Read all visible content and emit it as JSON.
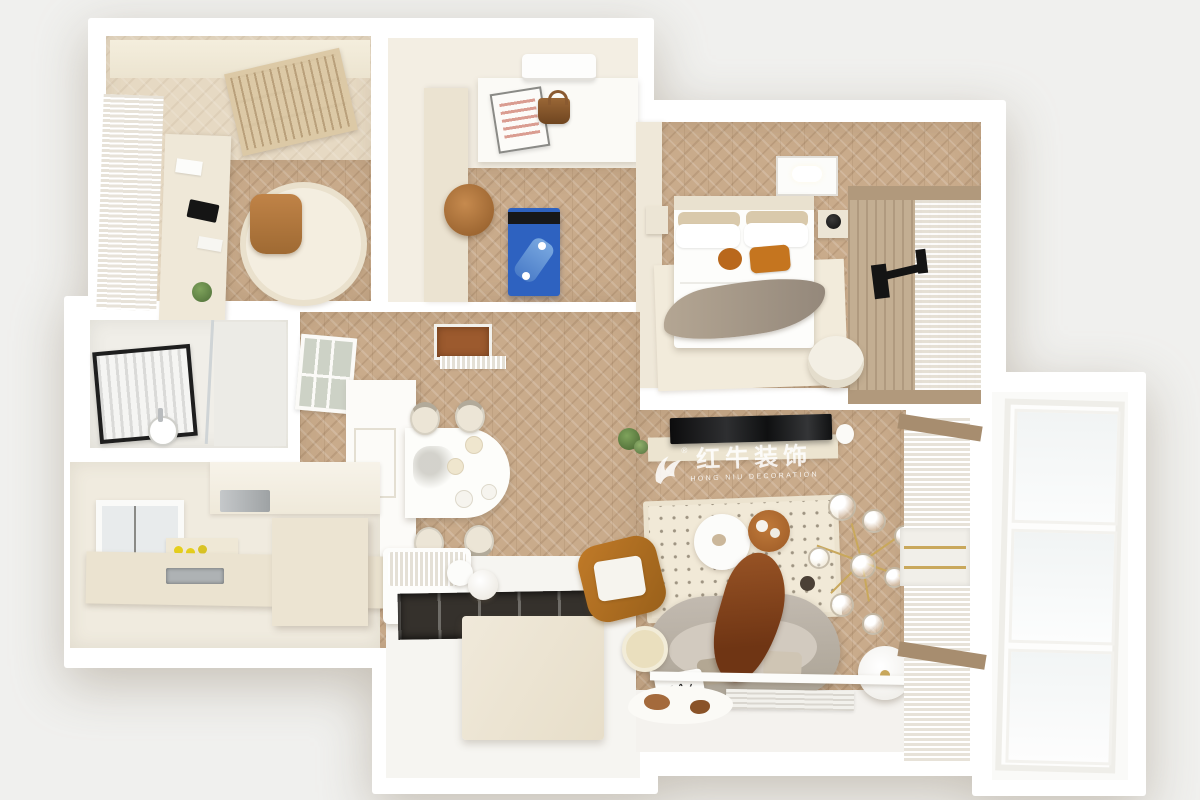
{
  "watermark": {
    "registered": "®",
    "brand_cn": "红牛装饰",
    "brand_en": "HONG NIU DECORATION",
    "logo": "bull-swoosh-logo",
    "color": "#ffffff"
  },
  "scene": {
    "type": "top-down 3D apartment render",
    "background": "#f0f0ee",
    "palette": {
      "walls": "#ffffff",
      "floor_wood_warm": "#c9ab8b",
      "floor_wood_pale": "#e6d9c3",
      "cream_furniture": "#ece4d2",
      "treadmill_blue": "#2e62c0",
      "accent_orange": "#c5751f",
      "sofa_gray": "#b8b0a5",
      "throw_brown": "#84451f",
      "bean_bag_tan": "#b0773f",
      "mirror_frame_black": "#1e1e1e"
    },
    "rooms": [
      {
        "name": "study",
        "objects": [
          "wardrobe",
          "bookshelf",
          "window-curtain",
          "desk",
          "monitor",
          "desk-chair",
          "oval-rug",
          "plant"
        ]
      },
      {
        "name": "fitness-room",
        "objects": [
          "air-conditioner",
          "counter",
          "picture-frame",
          "handbag",
          "bean-bag",
          "treadmill"
        ]
      },
      {
        "name": "master-bedroom",
        "objects": [
          "wardrobe",
          "double-bed",
          "pillows",
          "orange-cushions",
          "throw-blanket",
          "nightstands",
          "ceiling-light",
          "wood-slat-tv-wall",
          "tv-bracket",
          "curtains",
          "armchair",
          "area-rug"
        ]
      },
      {
        "name": "bathroom",
        "objects": [
          "framed-mirror",
          "sink",
          "glass-partition"
        ]
      },
      {
        "name": "kitchen",
        "objects": [
          "window",
          "upper-cabinets",
          "range-hood",
          "fruit-shelf",
          "counter",
          "sink",
          "island"
        ]
      },
      {
        "name": "dining-hall",
        "objects": [
          "glass-grid-partition",
          "skylight",
          "doormat",
          "island-counter",
          "oval-dining-table",
          "dining-chairs",
          "tableware"
        ]
      },
      {
        "name": "entry",
        "objects": [
          "bench",
          "bolster-cushion",
          "floor-recess",
          "cabinet-block",
          "pouf"
        ]
      },
      {
        "name": "living-room",
        "objects": [
          "tv",
          "tv-console",
          "plant",
          "polka-dot-rug",
          "round-coffee-table",
          "wood-tray-table",
          "curved-sofa",
          "throw-blanket",
          "script-pillow",
          "side-table",
          "chandelier",
          "floor-lamp",
          "shelf-strip",
          "doormat",
          "cowhide-rug",
          "curtains",
          "lounge-chair"
        ]
      },
      {
        "name": "balcony",
        "objects": [
          "glass-doors"
        ]
      }
    ]
  }
}
